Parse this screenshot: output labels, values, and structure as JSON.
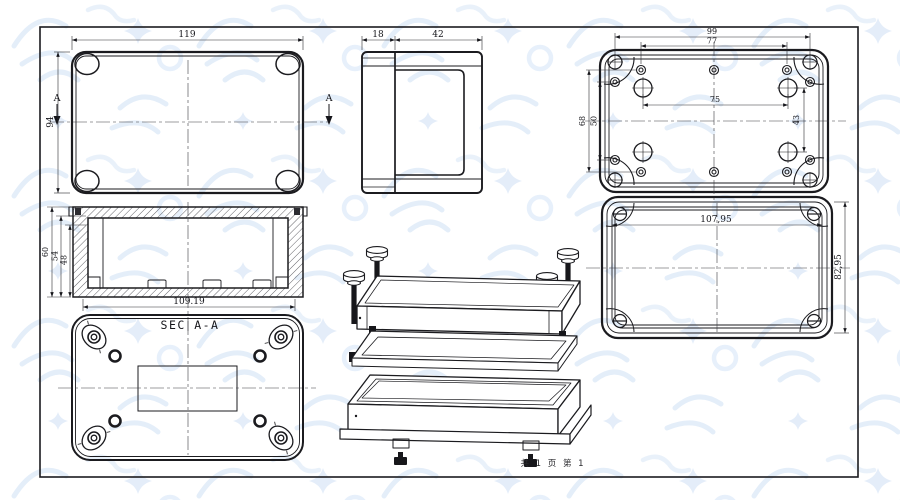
{
  "canvas": {
    "footer_page_info": "共 1 页  第 1"
  },
  "views": {
    "lid_top_view": {
      "dim_width": "119",
      "dim_height": "94",
      "section_marker_left": "A",
      "section_marker_right": "A"
    },
    "side_view": {
      "dim_lid_thickness": "18",
      "dim_base_depth": "42"
    },
    "base_inner_view": {
      "dim_corner_screw_span_w": "99",
      "dim_hole_row_span_w": "77",
      "dim_boss_span_w": "75",
      "dim_hole_row_span_h": "68",
      "dim_side_hole_span_h": "50",
      "dim_boss_span_h": "43"
    },
    "lid_inner_view": {
      "dim_inner_width": "107,95",
      "dim_inner_height": "82,95"
    },
    "section_view": {
      "label": "SEC A-A",
      "dim_overall_height": "60",
      "dim_mid_height": "54",
      "dim_inner_height": "48",
      "dim_inner_width": "109.19"
    }
  }
}
